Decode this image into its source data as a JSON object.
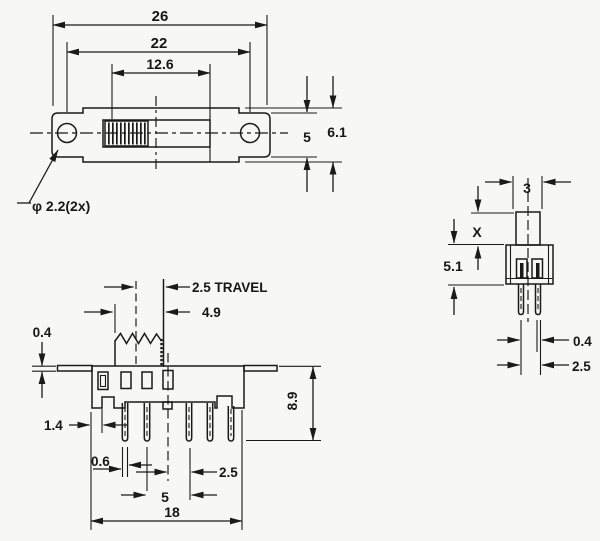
{
  "drawing_title": "slide switch dimension drawing",
  "colors": {
    "ink": "#1a1a1a",
    "paper": "#f7f7f5"
  },
  "top_view": {
    "dim_overall_length": "26",
    "dim_hole_spacing": "22",
    "dim_slot_length": "12.6",
    "dim_bracket_width": "5",
    "dim_body_width": "6.1",
    "hole_callout": "φ 2.2(2x)"
  },
  "front_view": {
    "dim_travel": "2.5  TRAVEL",
    "dim_knob_width": "4.9",
    "dim_flange_thickness": "0.4",
    "dim_edge_to_notch": "1.4",
    "dim_pin_width": "0.6",
    "dim_center_to_pin": "2.5",
    "dim_pin_span": "5",
    "dim_body_length": "18",
    "dim_overall_height": "8.9"
  },
  "side_view": {
    "dim_knob_depth": "3",
    "dim_knob_height": "X",
    "dim_body_height": "5.1",
    "dim_pin_thickness": "0.4",
    "dim_pin_pitch": "2.5"
  }
}
